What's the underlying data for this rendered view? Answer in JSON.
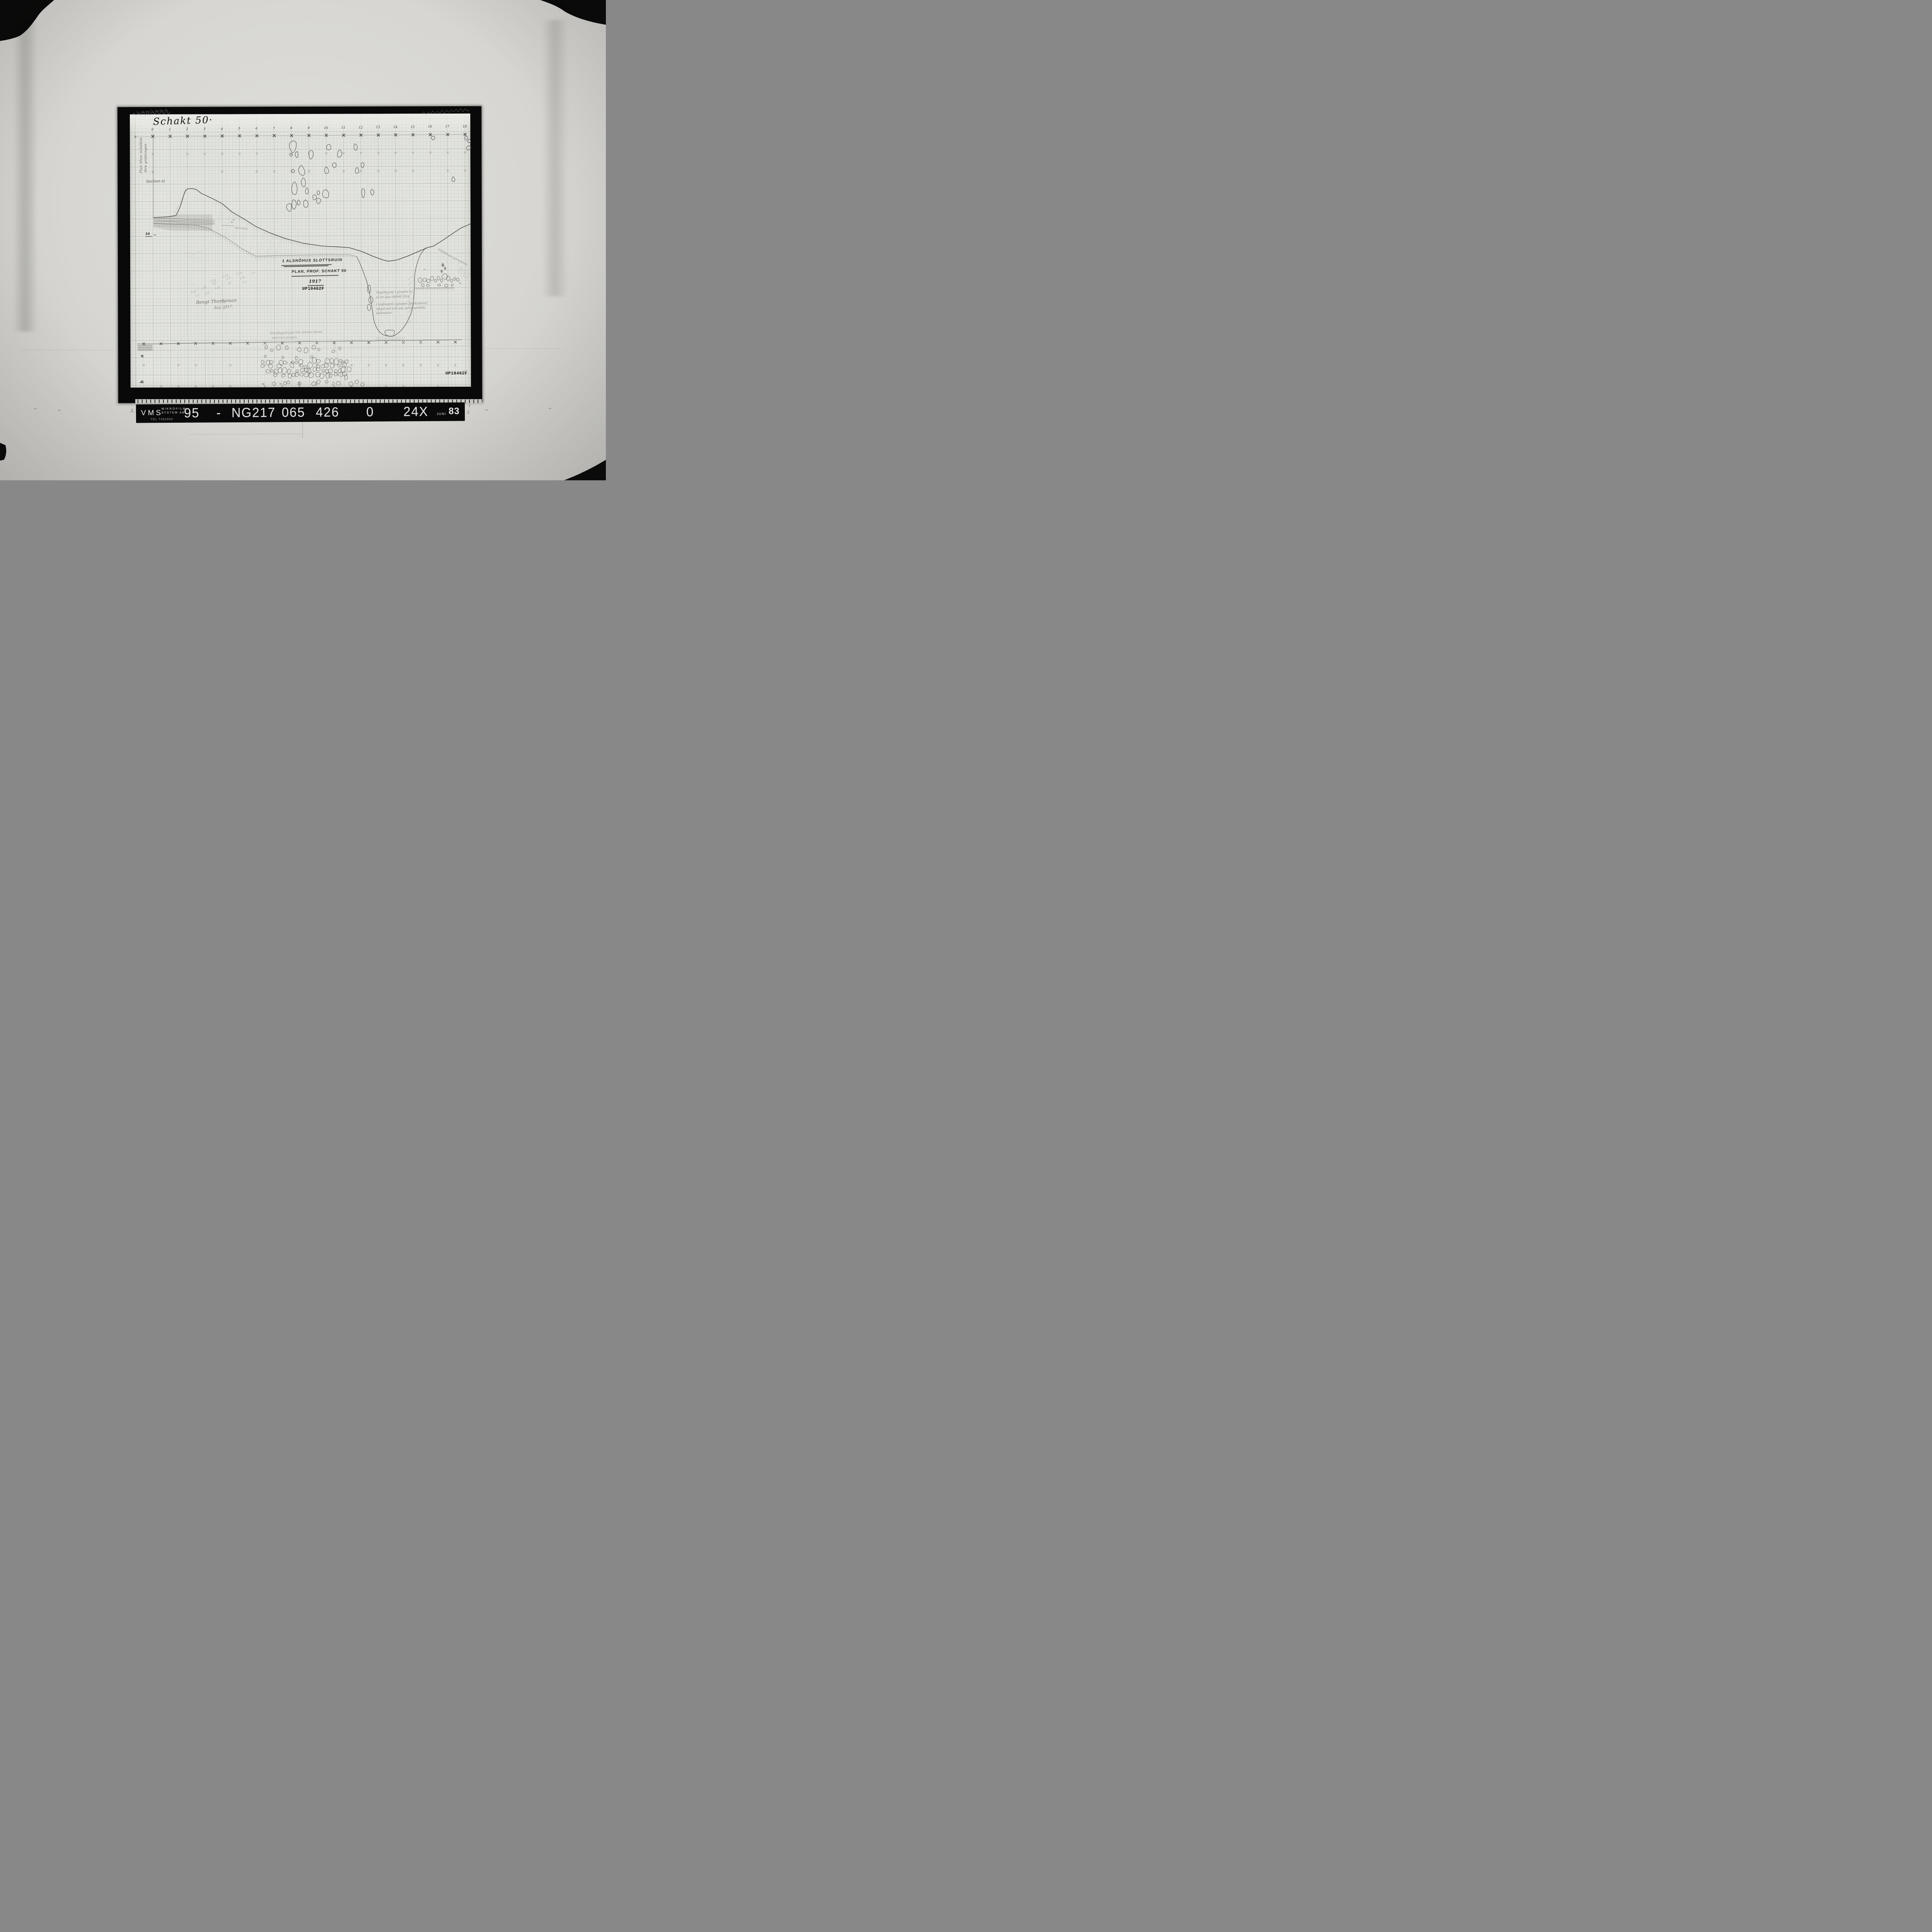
{
  "photo": {
    "sheet": {
      "title": "Schakt 50·",
      "plan_label_line1": "Plan öfver schaktet",
      "plan_label_line2": "före gräfningen",
      "section_label": "Section a)",
      "scale_numbers": [
        "0",
        "1",
        "2",
        "3",
        "4",
        "5",
        "6",
        "7",
        "8",
        "9",
        "10",
        "11",
        "12",
        "13",
        "14",
        "15",
        "16",
        "17",
        "18"
      ],
      "level_marker": "10",
      "find_label": "Spjutspets",
      "measurements": [
        "2.16",
        "1.5",
        "2.16",
        "1.07",
        "2.16",
        "63",
        "1.42",
        "2.16",
        "2.3",
        "93",
        "2.16",
        "1.54",
        "1.2",
        "1.6",
        "2.16",
        "1.75",
        "38"
      ],
      "center_label": {
        "line1": "1 ALSNÖHUS SLOTTSRUIN",
        "line2": "PLAN, PROF. SCHAKT 50",
        "line3": "1917",
        "stamp": "UP10462F"
      },
      "note_right_lines": [
        "Tegellagret i gropen är",
        "af en ljus rödlett färg.",
        "I myllagret i gropen förekommer",
        "något kol och sot, samt spridda",
        "kolsmulor."
      ],
      "signature_name": "Bengt Thordeman",
      "signature_date": "Aug. 1917.",
      "bottom_note_line1": "Stenläggningen här sluttar jämnt",
      "bottom_note_line2": "ned mot gropen.",
      "band_letter_a": "a",
      "band_letter_b": "b",
      "band_numbers": [
        "8",
        "9",
        "10",
        "11",
        "12"
      ],
      "corner_stamp": "UP10462F",
      "corner_stamp_note": "20"
    },
    "footer": {
      "brand": "VMS",
      "brand_sub1": "MIKROFILM",
      "brand_sub2": "SYSTEM AB",
      "tel": "TEL 7392850",
      "reel_prefix": "95",
      "reel_dash": "-",
      "reel_number": "NG217",
      "frame_code": "065 426",
      "flag": "0",
      "magnification": "24X",
      "month": "JUNI",
      "year": "83"
    },
    "edge_marks": {
      "left": "2,",
      "right_top": "1",
      "right_bottom": "2"
    }
  }
}
